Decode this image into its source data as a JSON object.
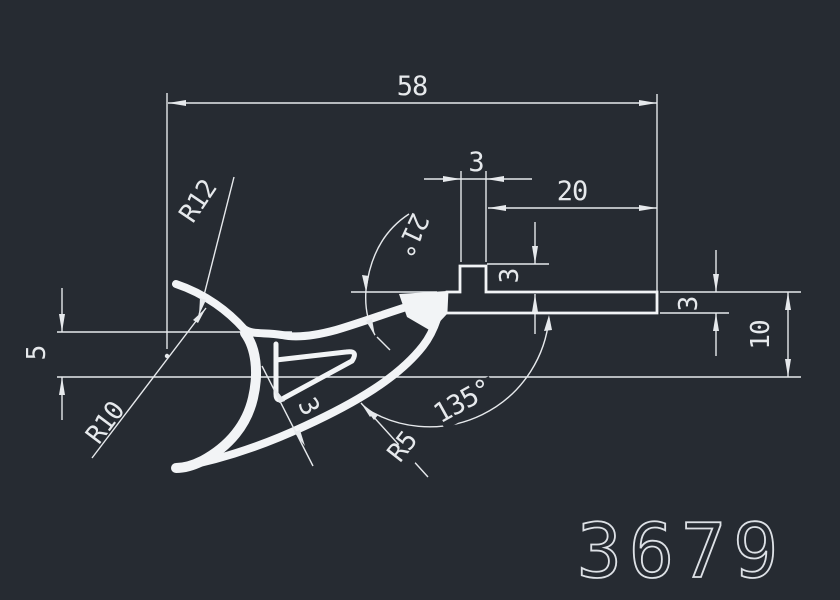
{
  "drawing": {
    "part_number": "3679",
    "colors": {
      "background": "#262b32",
      "dimension_lines": "#e6e9ec",
      "profile": "#f2f4f6"
    },
    "dimensions": {
      "total_width": "58",
      "tab_width": "3",
      "flange_right_length": "20",
      "tab_height": "3",
      "top_slope_angle": "21°",
      "flange_thickness": "3",
      "right_height": "10",
      "left_drop": "5",
      "hook_outer_radius": "R12",
      "hook_inner_radius": "R10",
      "lip_radius": "R5",
      "slot_gap": "3",
      "arm_angle": "135°"
    }
  }
}
